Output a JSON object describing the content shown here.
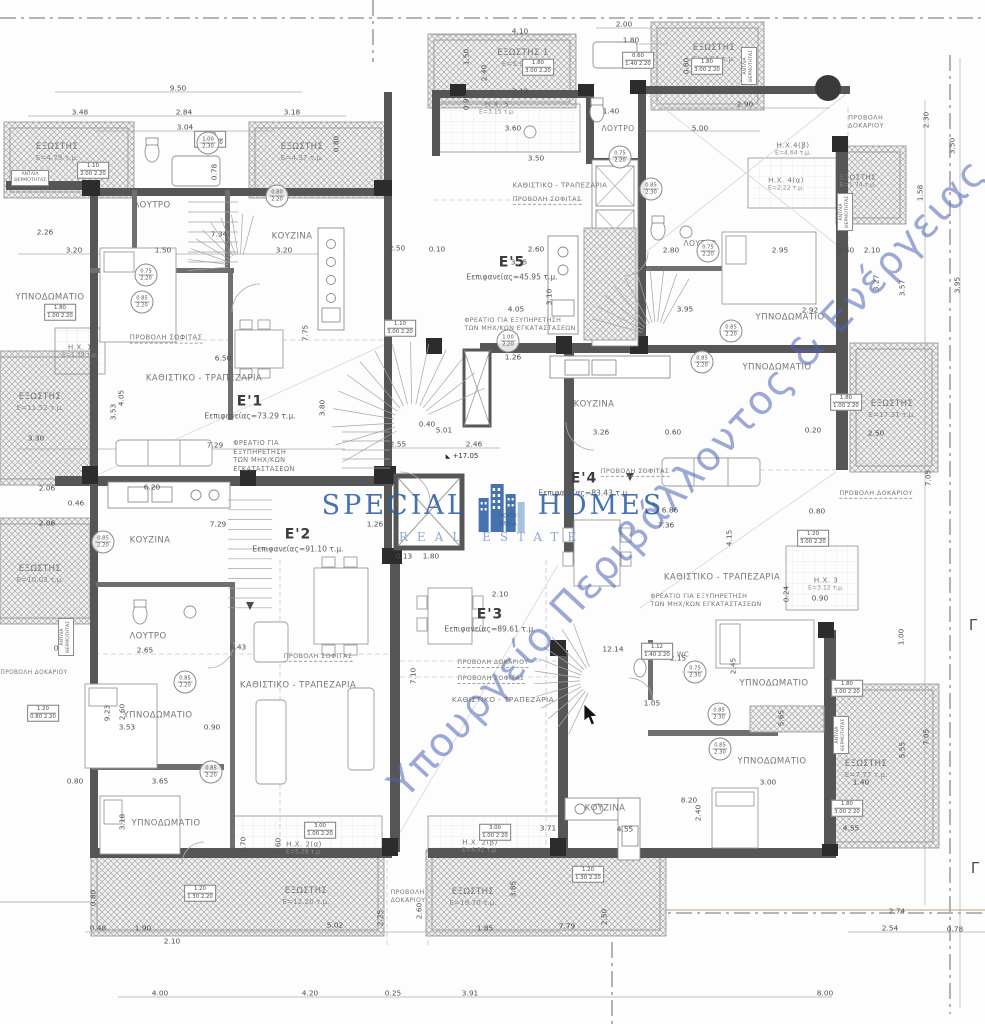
{
  "logo": {
    "word1": "SPECIAL",
    "word2": "HOMES",
    "subtitle": "REAL ESTATE",
    "accent_color": "#2d5fa6"
  },
  "watermark": {
    "text": "Υπουργείο Περιβάλλοντος & Ενέργειας",
    "color": "#4d63b6"
  },
  "markers": {
    "gamma": "Γ",
    "elevation": "+17.05",
    "elevation_x": 462,
    "elevation_y": 456
  },
  "apartments": [
    {
      "name": "E'1",
      "area": "Εεπιφανείας=73.29 τ.μ.",
      "x": 250,
      "y": 407
    },
    {
      "name": "E'2",
      "area": "Εεπιφανείας=91.10 τ.μ.",
      "x": 298,
      "y": 540
    },
    {
      "name": "E'3",
      "area": "Εεπιφανείας=89.61 τ.μ.",
      "x": 490,
      "y": 620
    },
    {
      "name": "E'4",
      "area": "Εεπιφανείας=83.43 τ.μ.",
      "x": 584,
      "y": 484
    },
    {
      "name": "E'5",
      "area": "Εεπιφανείας=45.95 τ.μ.",
      "x": 512,
      "y": 268
    }
  ],
  "rooms": [
    {
      "t": "ΕΞΩΣΤΗΣ",
      "a": "Ε=4.79 τ.μ.",
      "x": 57,
      "y": 152
    },
    {
      "t": "ΕΞΩΣΤΗΣ",
      "a": "Ε=4.37 τ.μ.",
      "x": 302,
      "y": 152
    },
    {
      "t": "ΛΟΥΤΡΟ",
      "x": 152,
      "y": 206
    },
    {
      "t": "ΚΟΥΖΙΝΑ",
      "x": 292,
      "y": 237
    },
    {
      "t": "ΥΠΝΟΔΩΜΑΤΙΟ",
      "x": 50,
      "y": 298
    },
    {
      "t": "Η.Χ. 1",
      "a": "Ε=1.39 τ.μ.",
      "x": 80,
      "y": 351,
      "fs": 7.2
    },
    {
      "t": "ΕΞΩΣΤΗΣ",
      "a": "Ε=11.52 τ.μ.",
      "x": 40,
      "y": 402
    },
    {
      "t": "ΠΡΟΒΟΛΗ ΣΟΦΙΤΑΣ",
      "x": 166,
      "y": 338,
      "fs": 6.8,
      "u": 1
    },
    {
      "t": "ΚΑΘΙΣΤΙΚΟ - ΤΡΑΠΕΖΑΡΙΑ",
      "x": 204,
      "y": 379
    },
    {
      "t": "ΦΡΕΑΤΙΟ ΓΙΑ\nΕΞΥΠΗΡΕΤΗΣΗ\nΤΩΝ ΜΗΧ/ΚΩΝ\nΕΓΚΑΤΑΣΤΑΣΕΩΝ",
      "x": 264,
      "y": 456,
      "fs": 6.6,
      "ml": 1
    },
    {
      "t": "ΕΞΩΣΤΗΣ 1",
      "a": "Ε=5.97 τ.μ.",
      "x": 523,
      "y": 58
    },
    {
      "t": "Η.Χ. 5",
      "a": "Ε=3.15 τ.μ.",
      "x": 497,
      "y": 108,
      "fs": 7.2
    },
    {
      "t": "ΛΟΥΤΡΟ",
      "x": 618,
      "y": 129,
      "fs": 7.5
    },
    {
      "t": "ΚΑΘΙΣΤΙΚΟ - ΤΡΑΠΕΖΑΡΙΑ",
      "x": 560,
      "y": 186,
      "fs": 6.8
    },
    {
      "t": "ΠΡΟΒΟΛΗ ΣΟΦΙΤΑΣ",
      "x": 547,
      "y": 199,
      "fs": 6.4,
      "u": 1
    },
    {
      "t": "ΦΡΕΑΤΙΟ ΓΙΑ ΕΞΥΠΗΡΕΤΗΣΗ\nΤΩΝ ΜΗΧ/ΚΩΝ ΕΓΚΑΤΑΣΤΑΣΕΩΝ",
      "x": 520,
      "y": 325,
      "fs": 6.3,
      "ml": 1
    },
    {
      "t": "ΚΟΥΖΙΝΑ",
      "x": 594,
      "y": 405
    },
    {
      "t": "ΕΞΩΣΤΗΣ",
      "a": "Ε=4.24 τ.μ.",
      "x": 714,
      "y": 53
    },
    {
      "t": "ΠΡΟΒΟΛΗ\nΔΟΚΑΡΙΟΥ",
      "x": 866,
      "y": 122,
      "fs": 6.4,
      "ml": 1
    },
    {
      "t": "Η.Χ.4(β)",
      "a": "Ε=4.64 τ.μ.",
      "x": 793,
      "y": 149,
      "fs": 7.2
    },
    {
      "t": "Η.Χ. 4(α)",
      "a": "Ε=2.22 τ.μ.",
      "x": 786,
      "y": 184,
      "fs": 7.2
    },
    {
      "t": "ΕΞΩΣΤΗΣ",
      "a": "Ε=1.74 τ.μ.",
      "x": 858,
      "y": 181,
      "fs": 7.2
    },
    {
      "t": "ΛΟΥΤΡΟ",
      "x": 700,
      "y": 244,
      "fs": 7.5
    },
    {
      "t": "ΥΠΝΟΔΩΜΑΤΙΟ",
      "x": 790,
      "y": 318
    },
    {
      "t": "ΥΠΝΟΔΩΜΑΤΙΟ",
      "x": 777,
      "y": 368
    },
    {
      "t": "ΕΞΩΣΤΗΣ",
      "a": "Ε=17.31 τ.μ.",
      "x": 892,
      "y": 409
    },
    {
      "t": "ΠΡΟΒΟΛΗ ΔΟΚΑΡΙΟΥ",
      "x": 876,
      "y": 493,
      "fs": 6.4,
      "u": 1
    },
    {
      "t": "ΠΡΟΒΟΛΗ ΣΟΦΙΤΑΣ",
      "x": 635,
      "y": 471,
      "fs": 6.4,
      "u": 1
    },
    {
      "t": "ΚΑΘΙΣΤΙΚΟ - ΤΡΑΠΕΖΑΡΙΑ",
      "x": 722,
      "y": 578
    },
    {
      "t": "ΦΡΕΑΤΙΟ ΓΙΑ ΕΞΥΠΗΡΕΤΗΣΗ\nΤΩΝ ΜΗΧ/ΚΩΝ ΕΓΚΑΤΑΣΤΑΣΕΩΝ",
      "x": 706,
      "y": 601,
      "fs": 6.3,
      "ml": 1
    },
    {
      "t": "Η.Χ. 3",
      "a": "Ε=3.12 τ.μ.",
      "x": 826,
      "y": 584,
      "fs": 7.2
    },
    {
      "t": "WC",
      "x": 683,
      "y": 655,
      "fs": 6.8
    },
    {
      "t": "ΥΠΝΟΔΩΜΑΤΙΟ",
      "x": 774,
      "y": 684
    },
    {
      "t": "ΥΠΝΟΔΩΜΑΤΙΟ",
      "x": 772,
      "y": 762
    },
    {
      "t": "ΕΞΩΣΤΗΣ",
      "a": "Ε=7.77 τ.μ.",
      "x": 866,
      "y": 769
    },
    {
      "t": "ΚΟΥΖΙΝΑ",
      "x": 605,
      "y": 809
    },
    {
      "t": "ΚΟΥΖΙΝΑ",
      "x": 150,
      "y": 541
    },
    {
      "t": "ΕΞΩΣΤΗΣ",
      "a": "Ε=10.03 τ.μ.",
      "x": 40,
      "y": 574
    },
    {
      "t": "ΛΟΥΤΡΟ",
      "x": 148,
      "y": 637
    },
    {
      "t": "ΠΡΟΒΟΛΗ ΔΟΚΑΡΙΟΥ",
      "x": 34,
      "y": 674,
      "fs": 5.8
    },
    {
      "t": "ΥΠΝΟΔΩΜΑΤΙΟ",
      "x": 158,
      "y": 716
    },
    {
      "t": "ΥΠΝΟΔΩΜΑΤΙΟ",
      "x": 166,
      "y": 824
    },
    {
      "t": "ΠΡΟΒΟΛΗ ΣΟΦΙΤΑΣ",
      "x": 318,
      "y": 656,
      "fs": 6.4,
      "u": 1
    },
    {
      "t": "ΚΑΘΙΣΤΙΚΟ - ΤΡΑΠΕΖΑΡΙΑ",
      "x": 298,
      "y": 686
    },
    {
      "t": "Η.Χ. 2(α)",
      "a": "Ε=5.28 τ.μ.",
      "x": 304,
      "y": 848,
      "fs": 7.2
    },
    {
      "t": "ΕΞΩΣΤΗΣ",
      "a": "Ε=12.20 τ.μ.",
      "x": 306,
      "y": 896
    },
    {
      "t": "ΠΡΟΒΟΛΗ\nΔΟΚΑΡΙΟΥ",
      "x": 408,
      "y": 897,
      "fs": 6.2,
      "ml": 1
    },
    {
      "t": "Η.Χ. 2(β)",
      "a": "Ε=4.92 τ.μ.",
      "x": 480,
      "y": 846,
      "fs": 7.2
    },
    {
      "t": "ΕΞΩΣΤΗΣ",
      "a": "Ε=19.70 τ.μ.",
      "x": 473,
      "y": 897
    },
    {
      "t": "ΚΑΘΙΣΤΙΚΟ - ΤΡΑΠΕΖΑΡΙΑ",
      "x": 503,
      "y": 700,
      "fs": 7.4
    },
    {
      "t": "ΠΡΟΒΟΛΗ ΔΟΚΑΡΙΟΥ",
      "x": 493,
      "y": 663,
      "fs": 6.2,
      "u": 1
    },
    {
      "t": "ΠΡΟΒΟΛΗ ΣΟΦΙΤΑΣ",
      "x": 491,
      "y": 679,
      "fs": 6.2,
      "u": 1
    },
    {
      "t": "ΧΩΡΟΣ\nΑΜΕΑ",
      "x": 510,
      "y": 521,
      "fs": 5.8,
      "ml": 1
    }
  ],
  "pumps": [
    {
      "x": 30,
      "y": 178,
      "v": 0
    },
    {
      "x": 749,
      "y": 66,
      "v": 1
    },
    {
      "x": 845,
      "y": 212,
      "v": 1
    },
    {
      "x": 66,
      "y": 637,
      "v": 1
    },
    {
      "x": 841,
      "y": 735,
      "v": 1
    }
  ],
  "pump_label": "ΑΝΤΛΙΑ\nΘΕΡΜΟΤΗΤΑΣ",
  "window_tags": [
    {
      "x": 210,
      "y": 139,
      "a": "0.80",
      "b": "1.40 2.20"
    },
    {
      "x": 93,
      "y": 170,
      "a": "1.10",
      "b": "2.00 2.20"
    },
    {
      "x": 538,
      "y": 67,
      "a": "1.80",
      "b": "3.00 2.20"
    },
    {
      "x": 707,
      "y": 66,
      "a": "1.80",
      "b": "3.00 2.20"
    },
    {
      "x": 638,
      "y": 60,
      "a": "0.60",
      "b": "1.40 2.20"
    },
    {
      "x": 400,
      "y": 328,
      "a": "1.10",
      "b": "3.00 2.20"
    },
    {
      "x": 60,
      "y": 312,
      "a": "1.80",
      "b": "1.00 2.20"
    },
    {
      "x": 43,
      "y": 713,
      "a": "1.20",
      "b": "0.80 2.20"
    },
    {
      "x": 847,
      "y": 688,
      "a": "1.80",
      "b": "3.00 2.20"
    },
    {
      "x": 847,
      "y": 808,
      "a": "1.80",
      "b": "3.00 2.20"
    },
    {
      "x": 588,
      "y": 874,
      "a": "1.20",
      "b": "1.30 2.20"
    },
    {
      "x": 320,
      "y": 830,
      "a": "3.00",
      "b": "1.00 2.20"
    },
    {
      "x": 495,
      "y": 832,
      "a": "3.00",
      "b": "1.00 2.20"
    },
    {
      "x": 813,
      "y": 538,
      "a": "1.20",
      "b": "3.00 2.20"
    },
    {
      "x": 846,
      "y": 402,
      "a": "1.80",
      "b": "1.00 2.20"
    },
    {
      "x": 657,
      "y": 651,
      "a": "1.12",
      "b": "1.40 2.20"
    },
    {
      "x": 200,
      "y": 893,
      "a": "1.20",
      "b": "1.30 2.20"
    }
  ],
  "door_tags": [
    {
      "x": 208,
      "y": 143,
      "a": "1.00",
      "b": "2.30"
    },
    {
      "x": 277,
      "y": 196,
      "a": "0.80",
      "b": "2.20"
    },
    {
      "x": 146,
      "y": 275,
      "a": "0.75",
      "b": "2.20"
    },
    {
      "x": 142,
      "y": 302,
      "a": "0.85",
      "b": "2.20"
    },
    {
      "x": 508,
      "y": 341,
      "a": "1.00",
      "b": "2.20"
    },
    {
      "x": 620,
      "y": 157,
      "a": "0.75",
      "b": "2.20"
    },
    {
      "x": 651,
      "y": 189,
      "a": "0.85",
      "b": "2.30"
    },
    {
      "x": 708,
      "y": 251,
      "a": "0.75",
      "b": "2.20"
    },
    {
      "x": 731,
      "y": 331,
      "a": "0.85",
      "b": "2.20"
    },
    {
      "x": 702,
      "y": 362,
      "a": "0.85",
      "b": "2.20"
    },
    {
      "x": 695,
      "y": 672,
      "a": "0.75",
      "b": "2.30"
    },
    {
      "x": 719,
      "y": 714,
      "a": "0.85",
      "b": "2.30"
    },
    {
      "x": 720,
      "y": 749,
      "a": "0.85",
      "b": "2.30"
    },
    {
      "x": 185,
      "y": 682,
      "a": "0.85",
      "b": "2.20"
    },
    {
      "x": 211,
      "y": 772,
      "a": "0.85",
      "b": "2.20"
    },
    {
      "x": 103,
      "y": 542,
      "a": "0.85",
      "b": "2.20"
    }
  ],
  "dims": [
    [
      178,
      88,
      "9.50",
      "h"
    ],
    [
      80,
      112,
      "3.48",
      "h"
    ],
    [
      184,
      112,
      "2.84",
      "h"
    ],
    [
      292,
      112,
      "3.18",
      "h"
    ],
    [
      185,
      127,
      "3.04",
      "h"
    ],
    [
      520,
      31,
      "4.10",
      "h"
    ],
    [
      624,
      24,
      "2.00",
      "h"
    ],
    [
      631,
      40,
      "1.80",
      "h"
    ],
    [
      466,
      57,
      "1.50",
      "v"
    ],
    [
      484,
      73,
      "2.40",
      "v"
    ],
    [
      520,
      91,
      "3.10",
      "h"
    ],
    [
      466,
      102,
      "0.90",
      "v"
    ],
    [
      513,
      128,
      "3.60",
      "h"
    ],
    [
      536,
      158,
      "3.50",
      "h"
    ],
    [
      611,
      111,
      "1.40",
      "h"
    ],
    [
      745,
      104,
      "2.90",
      "h"
    ],
    [
      700,
      128,
      "5.00",
      "h"
    ],
    [
      686,
      66,
      "0.80",
      "v"
    ],
    [
      336,
      144,
      "0.80",
      "v"
    ],
    [
      214,
      172,
      "0.78",
      "v"
    ],
    [
      45,
      232,
      "2.26",
      "h"
    ],
    [
      74,
      250,
      "3.20",
      "h"
    ],
    [
      163,
      250,
      "1.50",
      "h"
    ],
    [
      284,
      250,
      "3.20",
      "h"
    ],
    [
      219,
      234,
      "7.34",
      "h"
    ],
    [
      926,
      120,
      "2.30",
      "v"
    ],
    [
      952,
      146,
      "3.50",
      "v"
    ],
    [
      920,
      193,
      "1.58",
      "v"
    ],
    [
      876,
      283,
      "3.27",
      "v"
    ],
    [
      902,
      288,
      "3.57",
      "v"
    ],
    [
      957,
      285,
      "3.95",
      "v"
    ],
    [
      223,
      358,
      "6.50",
      "h"
    ],
    [
      121,
      398,
      "4.05",
      "v"
    ],
    [
      113,
      412,
      "3.53",
      "v"
    ],
    [
      36,
      438,
      "3.30",
      "h"
    ],
    [
      215,
      445,
      "7.29",
      "h"
    ],
    [
      322,
      408,
      "3.80",
      "v"
    ],
    [
      305,
      333,
      "7.75",
      "v"
    ],
    [
      47,
      488,
      "2.06",
      "h"
    ],
    [
      76,
      503,
      "0.46",
      "h"
    ],
    [
      47,
      523,
      "2.06",
      "h"
    ],
    [
      152,
      487,
      "6.20",
      "h"
    ],
    [
      218,
      524,
      "7.29",
      "h"
    ],
    [
      375,
      524,
      "1.26",
      "h"
    ],
    [
      404,
      556,
      "0.13",
      "h"
    ],
    [
      431,
      556,
      "1.80",
      "h"
    ],
    [
      238,
      647,
      "8.43",
      "h"
    ],
    [
      413,
      676,
      "7.10",
      "v"
    ],
    [
      397,
      248,
      "2.50",
      "h"
    ],
    [
      437,
      249,
      "0.10",
      "h"
    ],
    [
      536,
      249,
      "2.60",
      "h"
    ],
    [
      519,
      262,
      "3.55",
      "h"
    ],
    [
      549,
      297,
      "3.10",
      "v"
    ],
    [
      516,
      309,
      "4.05",
      "h"
    ],
    [
      513,
      357,
      "1.26",
      "h"
    ],
    [
      444,
      430,
      "5.01",
      "h"
    ],
    [
      398,
      444,
      "2.55",
      "h"
    ],
    [
      474,
      444,
      "2.46",
      "h"
    ],
    [
      427,
      424,
      "0.40",
      "h"
    ],
    [
      500,
      594,
      "2.10",
      "h"
    ],
    [
      613,
      649,
      "12.14",
      "h"
    ],
    [
      671,
      250,
      "2.80",
      "h"
    ],
    [
      780,
      250,
      "2.95",
      "h"
    ],
    [
      846,
      250,
      "0.60",
      "h"
    ],
    [
      872,
      250,
      "2.10",
      "h"
    ],
    [
      685,
      309,
      "3.95",
      "h"
    ],
    [
      810,
      310,
      "2.92",
      "h"
    ],
    [
      601,
      432,
      "3.26",
      "h"
    ],
    [
      813,
      430,
      "0.20",
      "h"
    ],
    [
      876,
      433,
      "2.50",
      "h"
    ],
    [
      673,
      432,
      "0.60",
      "h"
    ],
    [
      670,
      510,
      "6.86",
      "h"
    ],
    [
      666,
      525,
      "7.36",
      "h"
    ],
    [
      817,
      511,
      "0.80",
      "h"
    ],
    [
      928,
      478,
      "7.05",
      "v"
    ],
    [
      729,
      538,
      "4.15",
      "v"
    ],
    [
      786,
      594,
      "0.24",
      "v"
    ],
    [
      820,
      598,
      "0.90",
      "h"
    ],
    [
      901,
      637,
      "1.00",
      "v"
    ],
    [
      678,
      658,
      "2.15",
      "h"
    ],
    [
      652,
      703,
      "1.05",
      "h"
    ],
    [
      733,
      666,
      "2.45",
      "v"
    ],
    [
      781,
      718,
      "5.65",
      "v"
    ],
    [
      768,
      782,
      "3.00",
      "h"
    ],
    [
      861,
      782,
      "1.40",
      "h"
    ],
    [
      902,
      750,
      "5.55",
      "v"
    ],
    [
      926,
      737,
      "7.05",
      "v"
    ],
    [
      689,
      800,
      "8.20",
      "h"
    ],
    [
      698,
      813,
      "2.40",
      "v"
    ],
    [
      851,
      828,
      "4.55",
      "h"
    ],
    [
      897,
      911,
      "2.74",
      "h"
    ],
    [
      890,
      928,
      "2.54",
      "h"
    ],
    [
      955,
      929,
      "0.78",
      "h"
    ],
    [
      825,
      993,
      "8.00",
      "h"
    ],
    [
      93,
      898,
      "0.80",
      "v"
    ],
    [
      98,
      928,
      "0.48",
      "h"
    ],
    [
      143,
      928,
      "1.90",
      "h"
    ],
    [
      172,
      941,
      "2.10",
      "h"
    ],
    [
      335,
      925,
      "5.02",
      "h"
    ],
    [
      380,
      918,
      "2.25",
      "v"
    ],
    [
      485,
      928,
      "1.85",
      "h"
    ],
    [
      419,
      911,
      "2.60",
      "v"
    ],
    [
      160,
      993,
      "4.00",
      "h"
    ],
    [
      310,
      993,
      "4.20",
      "h"
    ],
    [
      393,
      993,
      "0.25",
      "h"
    ],
    [
      470,
      993,
      "3.91",
      "h"
    ],
    [
      567,
      926,
      "7.79",
      "h"
    ],
    [
      604,
      917,
      "2.50",
      "v"
    ],
    [
      513,
      889,
      "3.85",
      "v"
    ],
    [
      315,
      828,
      "4.00",
      "h"
    ],
    [
      548,
      828,
      "3.71",
      "h"
    ],
    [
      625,
      829,
      "4.55",
      "h"
    ],
    [
      243,
      845,
      "1.70",
      "v"
    ],
    [
      278,
      846,
      "1.60",
      "v"
    ],
    [
      160,
      781,
      "3.65",
      "h"
    ],
    [
      75,
      781,
      "0.80",
      "h"
    ],
    [
      122,
      822,
      "3.18",
      "v"
    ],
    [
      107,
      713,
      "9.23",
      "v"
    ],
    [
      122,
      712,
      "2.60",
      "v"
    ],
    [
      127,
      727,
      "3.53",
      "h"
    ],
    [
      212,
      727,
      "0.90",
      "h"
    ],
    [
      145,
      650,
      "2.65",
      "h"
    ],
    [
      31,
      713,
      "5.04",
      "v"
    ],
    [
      62,
      648,
      "0.80",
      "h"
    ]
  ]
}
